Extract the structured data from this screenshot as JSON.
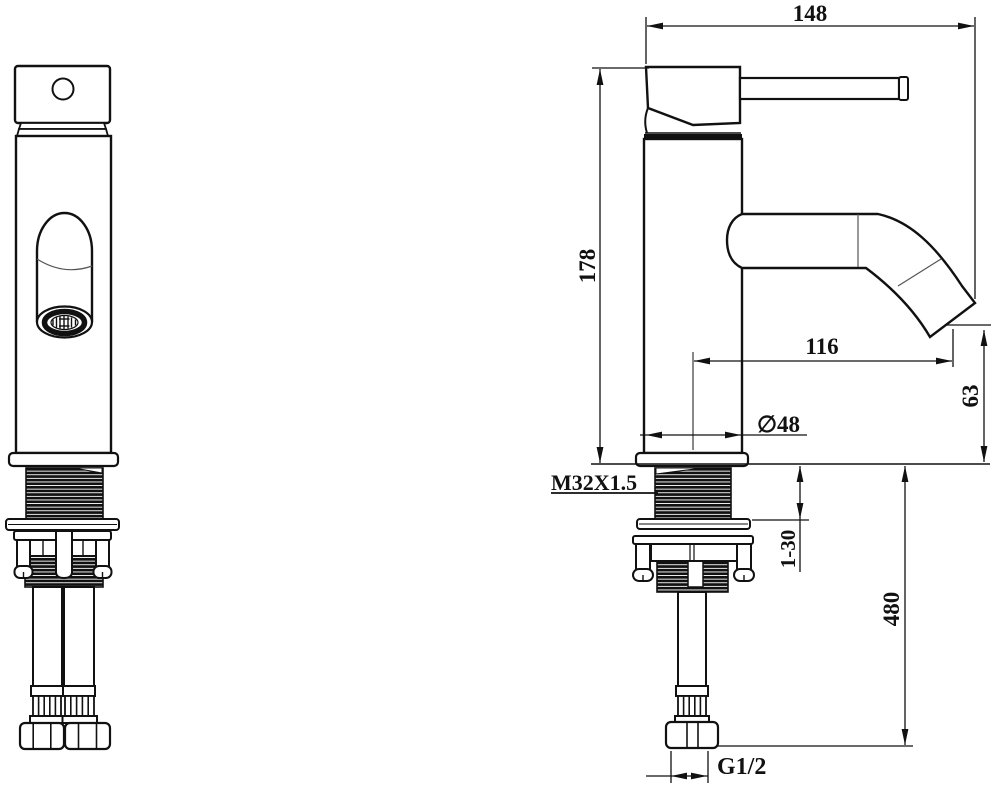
{
  "colors": {
    "background": "#ffffff",
    "line": "#111111"
  },
  "drawing": {
    "dimensions": {
      "reach_overall": "148",
      "height_overall": "178",
      "spout_reach": "116",
      "outlet_height": "63",
      "body_diameter": "∅48",
      "shank_thread": "M32X1.5",
      "deck_thickness_range": "1-30",
      "hose_length": "480",
      "inlet_thread": "G1/2"
    }
  }
}
